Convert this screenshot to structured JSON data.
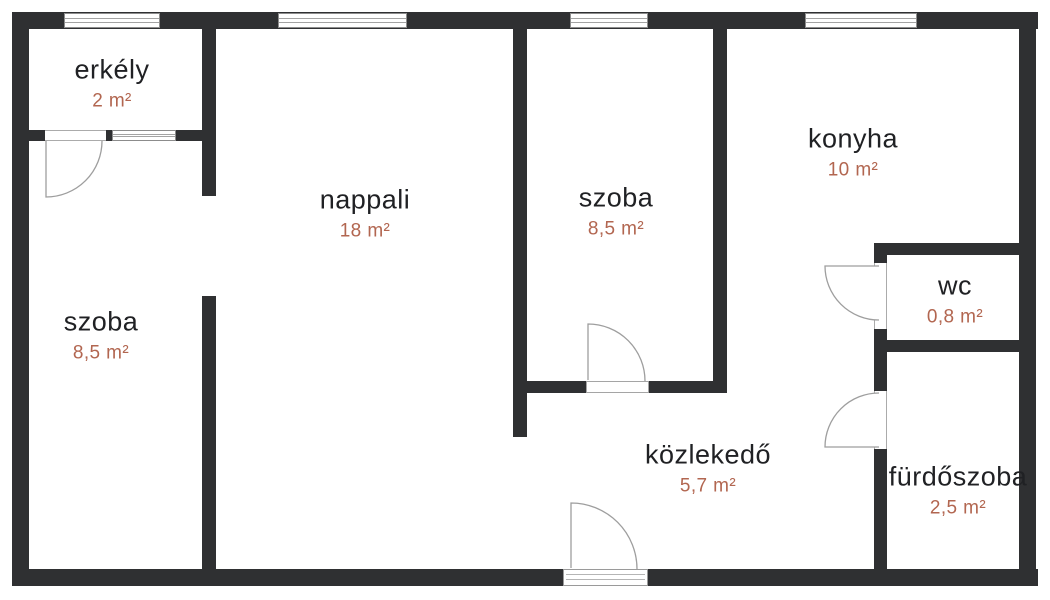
{
  "colors": {
    "wall": "#2f3032",
    "room_name": "#202124",
    "room_area": "#b26650",
    "door_line": "#9e9e9e",
    "window_frame": "#8c8c8c"
  },
  "rooms": [
    {
      "id": "erkely",
      "name": "erkély",
      "area": "2 m²"
    },
    {
      "id": "szoba-left",
      "name": "szoba",
      "area": "8,5 m²"
    },
    {
      "id": "nappali",
      "name": "nappali",
      "area": "18 m²"
    },
    {
      "id": "szoba-middle",
      "name": "szoba",
      "area": "8,5 m²"
    },
    {
      "id": "konyha",
      "name": "konyha",
      "area": "10 m²"
    },
    {
      "id": "wc",
      "name": "wc",
      "area": "0,8 m²"
    },
    {
      "id": "kozlekedo",
      "name": "közlekedő",
      "area": "5,7 m²"
    },
    {
      "id": "furdoszoba",
      "name": "fürdőszoba",
      "area": "2,5 m²"
    }
  ]
}
